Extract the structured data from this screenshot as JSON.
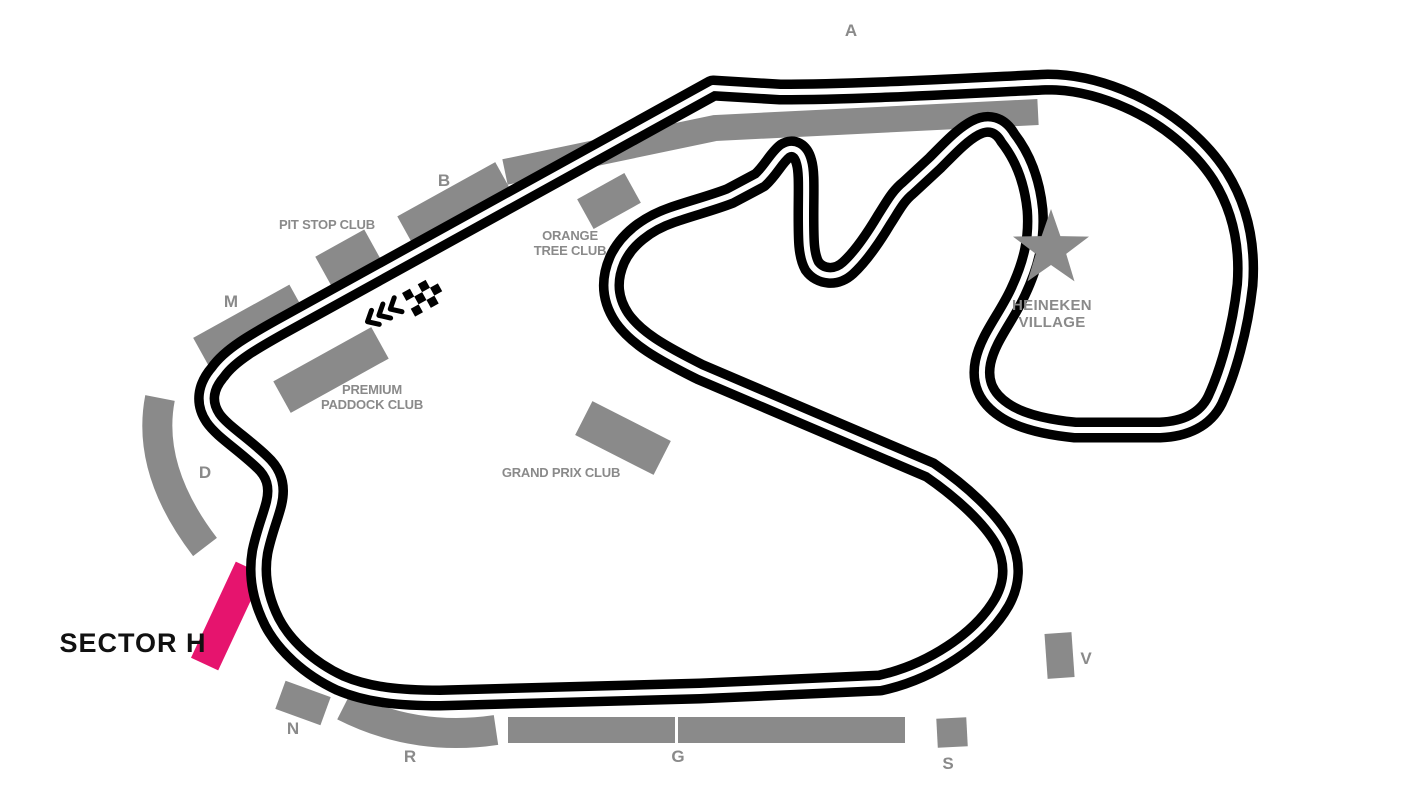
{
  "map": {
    "background": "#ffffff",
    "colors": {
      "track": "#000000",
      "track_stripe": "#ffffff",
      "stand_gray": "#8a8a8a",
      "label_gray": "#8a8a8a",
      "highlight_pink": "#e6146e",
      "highlight_label_color": "#111111"
    },
    "grandstands": {
      "a": "A",
      "b": "B",
      "m": "M",
      "d": "D",
      "n": "N",
      "r": "R",
      "g": "G",
      "s": "S",
      "v": "V"
    },
    "clubs": {
      "pit_stop": "PIT STOP CLUB",
      "premium_paddock_line1": "PREMIUM",
      "premium_paddock_line2": "PADDOCK CLUB",
      "orange_tree_line1": "ORANGE",
      "orange_tree_line2": "TREE CLUB",
      "grand_prix": "GRAND PRIX CLUB"
    },
    "village": {
      "line1": "HEINEKEN",
      "line2": "VILLAGE"
    },
    "highlighted_sector": {
      "label": "SECTOR H"
    },
    "icons": {
      "village_star": "star-icon",
      "start_finish": "checkered-flag-icon",
      "race_direction": "chevrons-left-icon"
    }
  }
}
